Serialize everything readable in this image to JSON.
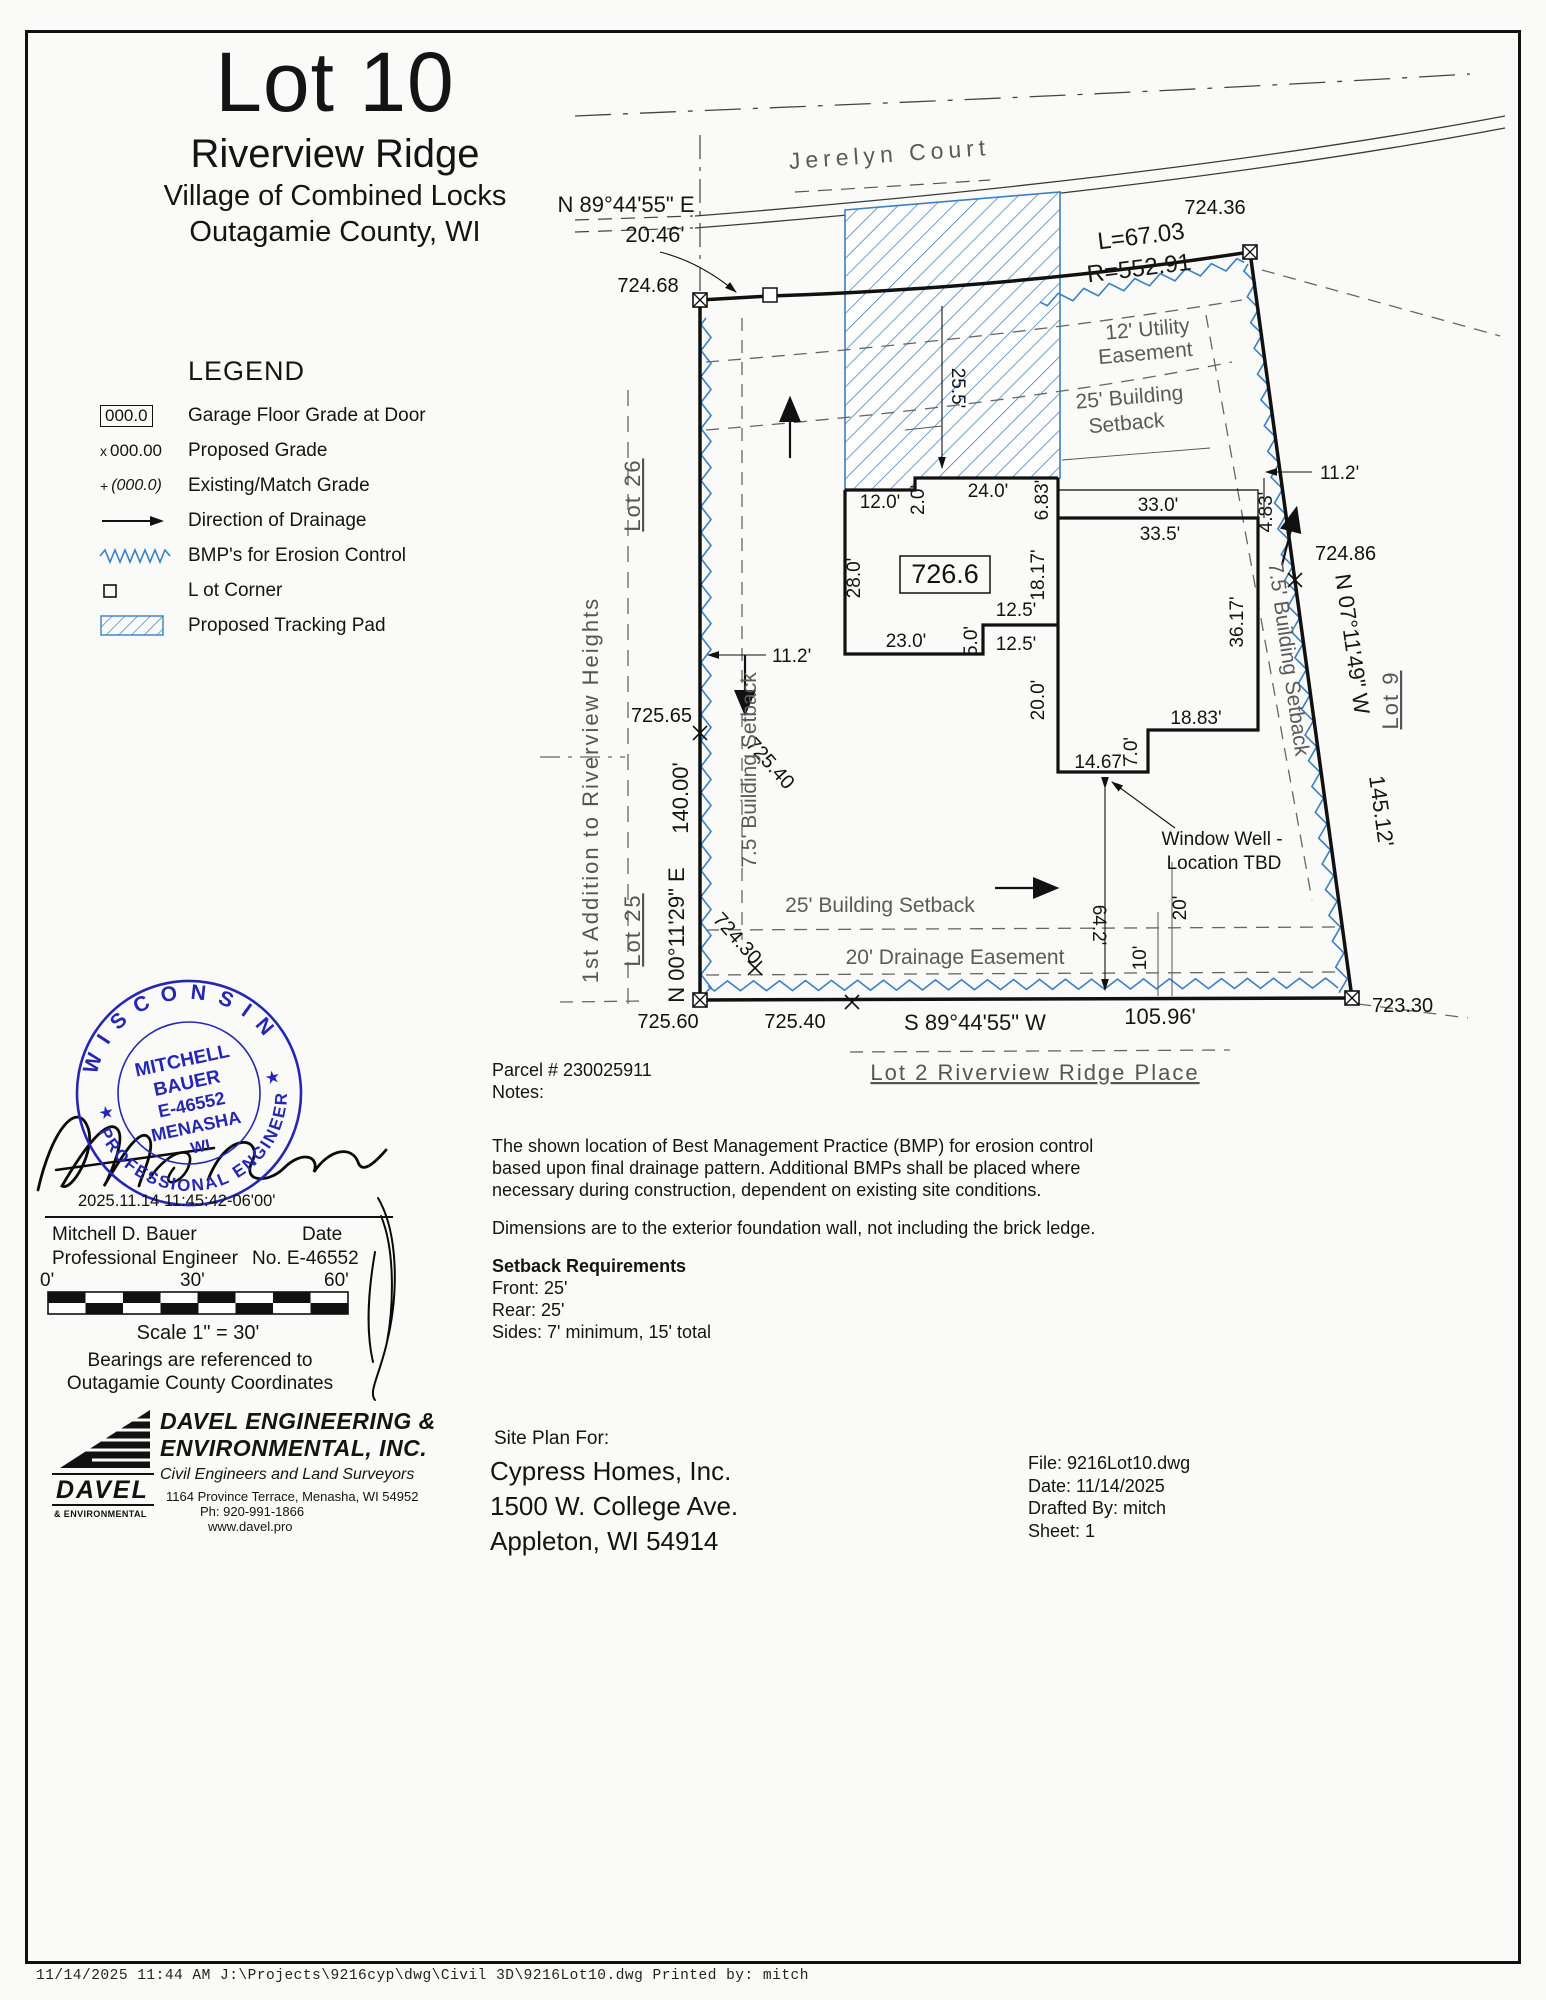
{
  "title": {
    "lot": "Lot 10",
    "subdivision": "Riverview Ridge",
    "line3": "Village of Combined Locks",
    "line4": "Outagamie County, WI"
  },
  "street": {
    "name": "Jerelyn  Court"
  },
  "legend": {
    "heading": "LEGEND",
    "symbols": {
      "grade_box": "000.0",
      "proposed": "000.00",
      "proposed_prefix": "x",
      "existing": "(000.0)",
      "existing_prefix": "+"
    },
    "items": [
      {
        "label": "Garage Floor Grade at Door"
      },
      {
        "label": "Proposed Grade"
      },
      {
        "label": "Existing/Match Grade"
      },
      {
        "label": "Direction of Drainage"
      },
      {
        "label": "BMP's for Erosion Control"
      },
      {
        "label": "L ot Corner"
      },
      {
        "label": "Proposed Tracking Pad"
      }
    ]
  },
  "plat": {
    "bearing_north": "N 89°44'55\" E",
    "bearing_north_len": "20.46'",
    "curve_l": "L=67.03",
    "curve_r": "R=552.91",
    "bearing_east": "N 07°11'49\" W",
    "bearing_east_len": "145.12'",
    "bearing_west": "N 00°11'29\" E",
    "bearing_west_len": "140.00'",
    "bearing_south": "S 89°44'55\" W",
    "bearing_south_len": "105.96'",
    "grades": {
      "nw": "724.68",
      "ne": "724.36",
      "e": "724.86",
      "w": "725.65",
      "w2": "725.40",
      "sw": "725.60",
      "s": "725.40",
      "s2": "724.30",
      "se": "723.30",
      "garage": "726.6"
    },
    "easements": {
      "utility1": "12'  Utility",
      "utility2": "Easement",
      "setback_top1": "25'  Building",
      "setback_top2": "Setback",
      "setback_bottom": "25'  Building  Setback",
      "drainage": "20'  Drainage  Easement",
      "setback_west": "7.5'  Building  Setback",
      "setback_east": "7.5'  Building  Setback"
    },
    "lots": {
      "lot26": "Lot  26",
      "lot25": "Lot  25",
      "lot9": "Lot  9",
      "lot2": "Lot  2  Riverview  Ridge  Place",
      "addition": "1st  Addition  to  Riverview  Heights"
    },
    "dims": {
      "d25_5": "25.5'",
      "d12": "12.0'",
      "d2": "2.0'",
      "d24": "24.0'",
      "d6_83": "6.83'",
      "d33": "33.0'",
      "d33_5": "33.5'",
      "d4_83": "4.83'",
      "d11_2e": "11.2'",
      "d11_2w": "11.2'",
      "d18_17": "18.17'",
      "d12_5a": "12.5'",
      "d12_5b": "12.5'",
      "d5": "5.0'",
      "d23": "23.0'",
      "d28": "28.0'",
      "d20": "20.0'",
      "d36_17": "36.17'",
      "d18_83": "18.83'",
      "d7": "7.0'",
      "d14_67": "14.67'",
      "d64_2": "64.2'",
      "d10": "10'",
      "d20b": "20'"
    },
    "window_well1": "Window Well -",
    "window_well2": "Location TBD"
  },
  "stamp": {
    "state": "W I S C O N S I N",
    "profession": "PROFESSIONAL  ENGINEER",
    "name1": "MITCHELL",
    "name2": "BAUER",
    "license": "E-46552",
    "city": "MENASHA",
    "state2": "WI",
    "star": "★",
    "timestamp": "2025.11.14 11:45:42-06'00'"
  },
  "signature_block": {
    "name": "Mitchell D. Bauer",
    "date_label": "Date",
    "title": "Professional Engineer",
    "license": "No. E-46552"
  },
  "scale": {
    "t0": "0'",
    "t30": "30'",
    "t60": "60'",
    "label": "Scale 1\" = 30'",
    "bearing_note1": "Bearings are referenced to",
    "bearing_note2": "Outagamie County Coordinates"
  },
  "firm": {
    "name1": "DAVEL ENGINEERING &",
    "name2": "ENVIRONMENTAL, INC.",
    "tagline": "Civil Engineers and Land Surveyors",
    "address": "1164 Province Terrace,  Menasha, WI  54952",
    "phone": "Ph:  920-991-1866",
    "web": "www.davel.pro",
    "logo1": "DAVEL",
    "logo2": "& ENVIRONMENTAL"
  },
  "client": {
    "heading": "Site Plan For:",
    "name": "Cypress Homes, Inc.",
    "address1": "1500 W. College Ave.",
    "address2": "Appleton, WI 54914"
  },
  "fileinfo": {
    "file": "File: 9216Lot10.dwg",
    "date": "Date: 11/14/2025",
    "drafted": "Drafted By: mitch",
    "sheet": "Sheet: 1"
  },
  "notes": {
    "parcel": "Parcel # 230025911",
    "heading": "Notes:",
    "bmp": "The shown location of Best Management Practice (BMP) for erosion control based upon final drainage pattern.  Additional BMPs shall be placed where necessary during construction, dependent on existing site conditions.",
    "dims_note": "Dimensions are to the exterior foundation wall, not including the brick ledge.",
    "setback_heading": "Setback Requirements",
    "front": "Front: 25'",
    "rear": "Rear: 25'",
    "sides": "Sides: 7' minimum, 15' total"
  },
  "footer": {
    "text": "11/14/2025 11:44 AM    J:\\Projects\\9216cyp\\dwg\\Civil 3D\\9216Lot10.dwg    Printed by:  mitch"
  }
}
